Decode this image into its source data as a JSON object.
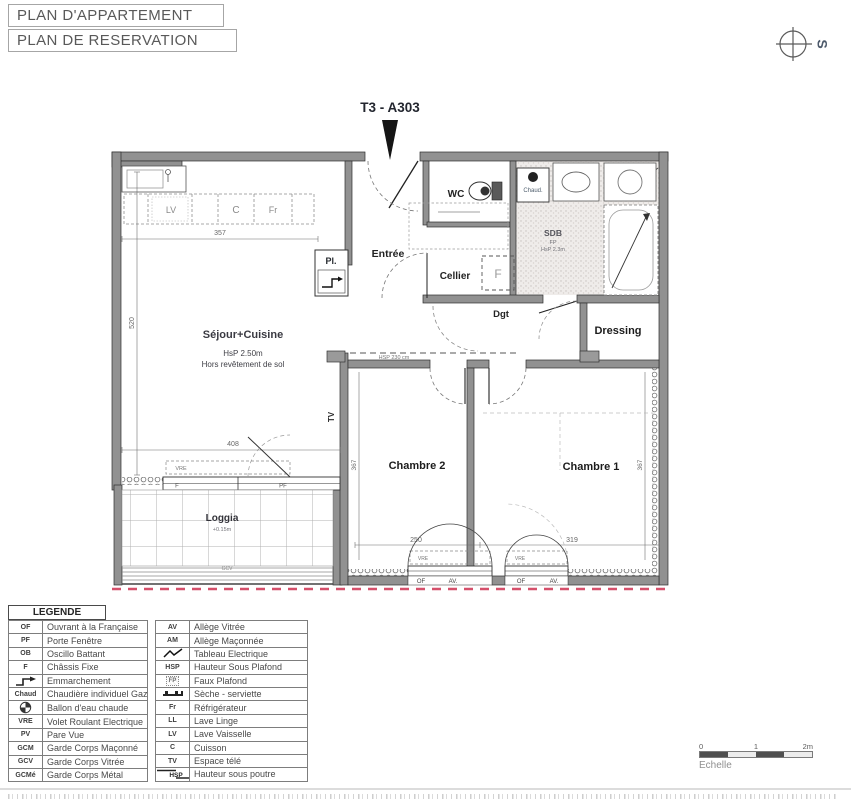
{
  "header": {
    "title1": "PLAN D'APPARTEMENT",
    "title2": "PLAN DE RESERVATION",
    "compass": "S"
  },
  "apartment": {
    "label": "T3 - A303"
  },
  "plan": {
    "rooms": {
      "sejour": "Séjour+Cuisine",
      "sejour_note1": "HsP 2.50m",
      "sejour_note2": "Hors revêtement de sol",
      "entree": "Entrée",
      "wc": "WC",
      "cellier": "Cellier",
      "sdb": "SDB",
      "sdb_note1": "FP",
      "sdb_note2": "HsP 2.3m",
      "dgt": "Dgt",
      "dressing": "Dressing",
      "chambre2": "Chambre 2",
      "chambre1": "Chambre 1",
      "loggia": "Loggia",
      "loggia_note": "+0.15m"
    },
    "labels": {
      "chaud": "Chaud.",
      "pl": "Pl.",
      "lv": "LV",
      "cuisson": "C",
      "fr": "Fr",
      "tv": "TV",
      "beam": "HSP 230 cm",
      "vre": "VRE",
      "f": "F",
      "pf": "PF",
      "of": "OF",
      "av": "AV.",
      "gcv": "GCV",
      "fixe": "F"
    },
    "dims": {
      "d357": "357",
      "d520": "520",
      "d408": "408",
      "d146": "146",
      "d377": "377",
      "d367a": "367",
      "d367b": "367",
      "d250": "250",
      "d319": "319"
    }
  },
  "legend": {
    "title": "LEGENDE",
    "left": [
      {
        "abbr": "OF",
        "label": "Ouvrant à la Française"
      },
      {
        "abbr": "PF",
        "label": "Porte Fenêtre"
      },
      {
        "abbr": "OB",
        "label": "Oscillo Battant"
      },
      {
        "abbr": "F",
        "label": "Châssis Fixe"
      },
      {
        "abbr": "",
        "label": "Emmarchement"
      },
      {
        "abbr": "Chaud",
        "label": "Chaudière individuel Gaz"
      },
      {
        "abbr": "",
        "label": "Ballon d'eau chaude"
      },
      {
        "abbr": "VRE",
        "label": "Volet Roulant Electrique"
      },
      {
        "abbr": "PV",
        "label": "Pare Vue"
      },
      {
        "abbr": "GCM",
        "label": "Garde Corps Maçonné"
      },
      {
        "abbr": "GCV",
        "label": "Garde Corps Vitrée"
      },
      {
        "abbr": "GCMé",
        "label": "Garde Corps Métal"
      }
    ],
    "right": [
      {
        "abbr": "AV",
        "label": "Allège Vitrée"
      },
      {
        "abbr": "AM",
        "label": "Allège Maçonnée"
      },
      {
        "abbr": "",
        "label": "Tableau Electrique"
      },
      {
        "abbr": "HSP",
        "label": "Hauteur Sous Plafond"
      },
      {
        "abbr": "FP",
        "label": "Faux Plafond"
      },
      {
        "abbr": "",
        "label": "Sèche - serviette"
      },
      {
        "abbr": "Fr",
        "label": "Réfrigérateur"
      },
      {
        "abbr": "LL",
        "label": "Lave Linge"
      },
      {
        "abbr": "LV",
        "label": "Lave Vaisselle"
      },
      {
        "abbr": "C",
        "label": "Cuisson"
      },
      {
        "abbr": "TV",
        "label": "Espace télé"
      },
      {
        "abbr": "HSP",
        "label": "Hauteur sous poutre"
      }
    ]
  },
  "scale": {
    "t0": "0",
    "t1": "1",
    "t2": "2m",
    "label": "Echelle"
  },
  "colors": {
    "wall": "#919191",
    "boundary_red": "#d5506b"
  }
}
